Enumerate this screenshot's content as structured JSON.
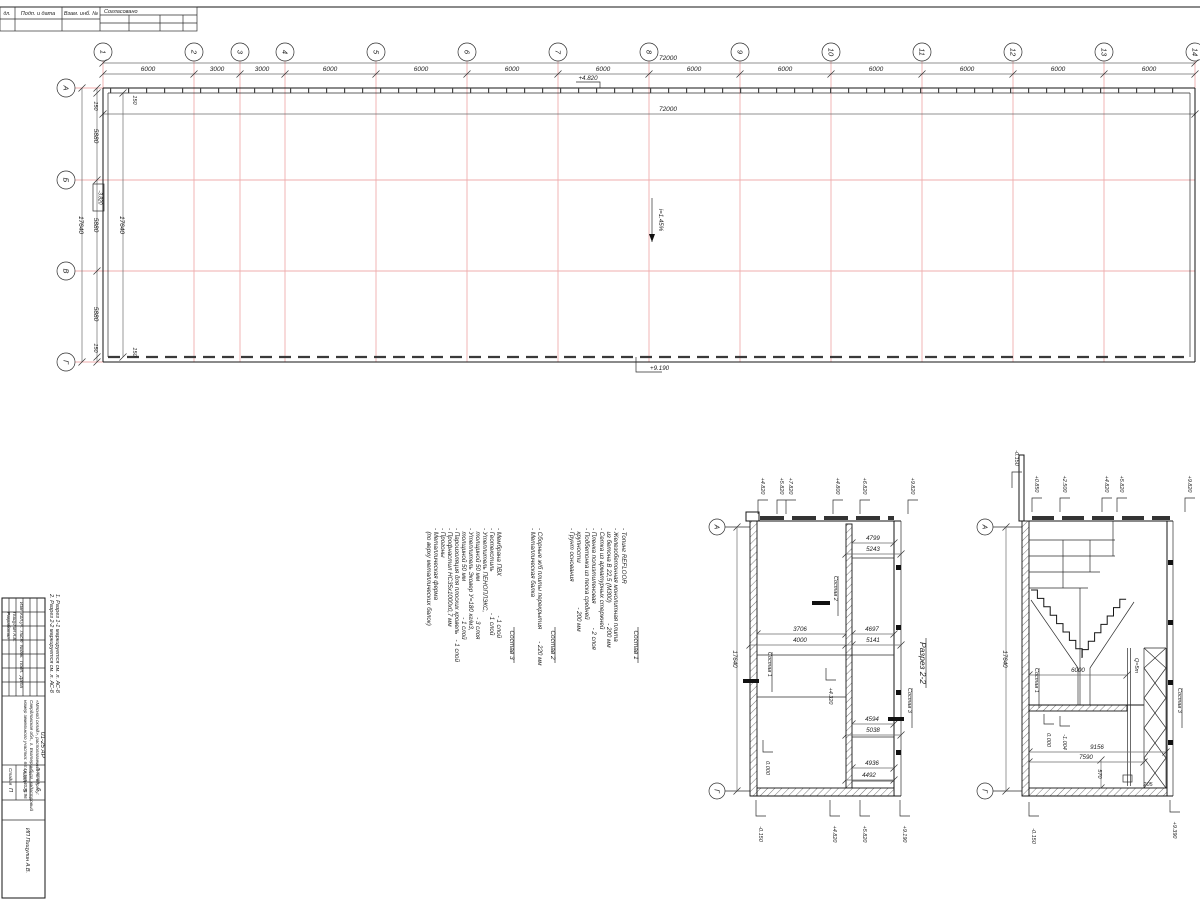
{
  "approval": {
    "c1": "дл.",
    "c2": "Подп. и дата",
    "c3": "Взам. инб. №",
    "header": "Согласовано"
  },
  "plan": {
    "axes_h": [
      "1",
      "2",
      "3",
      "4",
      "5",
      "6",
      "7",
      "8",
      "9",
      "10",
      "11",
      "12",
      "13",
      "14"
    ],
    "top_dims": [
      "6000",
      "3000",
      "3000",
      "6000",
      "6000",
      "6000",
      "6000",
      "6000",
      "6000",
      "6000",
      "6000",
      "6000",
      "6000"
    ],
    "total_top": "72000",
    "total_inner": "72000",
    "axes_v": [
      "А",
      "Б",
      "В",
      "Г"
    ],
    "left_chain": [
      "150",
      "5880",
      "5880",
      "5880",
      "150"
    ],
    "left_total": "17640",
    "left_inner": "17640",
    "off_tl": "150",
    "off_bl": "150",
    "elev_top": "+4.820",
    "elev_bottom": "+9.190",
    "slope": "i=1.45%",
    "elev_box": "-3.820"
  },
  "notes": {
    "c1": {
      "title": "Состав 1",
      "items": [
        "- Топинг REFLOOR",
        "- Железобетонная монолитная плита",
        "  из бетона В 22,5 (М300)            - 200 мм",
        "- Сетка из арматурных стержней",
        "- Пленка полиэтиленовая              - 2 слоя",
        "- Подбетонка из песка средней",
        "  крупности                          - 200 мм",
        "- Грунт основания"
      ]
    },
    "c2": {
      "title": "Состав 2",
      "items": [
        "- Сборные ж/б плиты перекрытия       - 220 мм",
        "- Металлическая балка"
      ]
    },
    "c3": {
      "title": "Состав 3",
      "items": [
        "- Мембрана ПВХ                       - 1 слой",
        "- Геотекстиль                        - 1 слой",
        "- Утеплитель ПЕНОПЛЭКС,",
        "  толщиной 50 мм                     - 3 слоя",
        "- Утеплитель Эковер У=180 кг/м3,",
        "  толщиной 50 мм                     - 1 слой",
        "- Пароизоляция для плоских кровель   - 1 слой",
        "- Профнастил НС35х1000х0,7 мм",
        "- Прогоны",
        "- Металлическая ферма",
        "  (по верху металлических балок)"
      ]
    }
  },
  "s2": {
    "title": "Разрез 2-2",
    "axA": "А",
    "axG": "Г",
    "h": "17640",
    "dims": [
      "4799",
      "5243",
      "3706",
      "4697",
      "4000",
      "5141",
      "4594",
      "5038",
      "4936",
      "4492"
    ],
    "top_elevs": [
      "+4.820",
      "+5.820",
      "+7.820",
      "+4.800",
      "+6.820",
      "+9.820"
    ],
    "bot_elevs": [
      "-0.150",
      "+4.820",
      "+5.820",
      "+9.190"
    ],
    "lab_c1": "Состав 1",
    "lab_c2": "Состав 2",
    "lab_c3": "Состав 3",
    "zero": "0.000",
    "mid": "+4.320"
  },
  "s1": {
    "axA": "А",
    "axG": "Г",
    "h": "17640",
    "dims": [
      "6000",
      "9156",
      "7590",
      "570",
      "205"
    ],
    "top_elevs": [
      "-0.150",
      "+0.850",
      "+2.500",
      "+4.820",
      "+5.820",
      "+9.820"
    ],
    "bot_elevs": [
      "-0.150",
      "+9.390"
    ],
    "crane": "Q=5т",
    "lab_c1": "Состав 1",
    "lab_c3": "Состав 3",
    "zero": "0.000",
    "pit": "-1.004"
  },
  "tb": {
    "note1": "1. Разрез 1-1 маркируется см. л. АС-8",
    "note2": "2. Разрез 2-2 маркируется см. л. АС-8",
    "header": "Изм  Кол.уч.  Лист  №док.  Подп.  Дата",
    "role": "Разработал",
    "name": "Пищулин А.В.",
    "doc": "01-25 АР",
    "proj1": "«Мясной склад», располагаемый по адресу:",
    "proj2": "Свердловская обл., г. Екатеринбург, кадастровый",
    "proj3": "номер земельного участка: 66:41:5854020:96",
    "stage_l": "Стадия",
    "sheet_l": "Лист",
    "sheets_l": "Листов",
    "stage": "П",
    "sheet": "5",
    "sheets": "6",
    "org": "ИП Пищулин А.В."
  }
}
